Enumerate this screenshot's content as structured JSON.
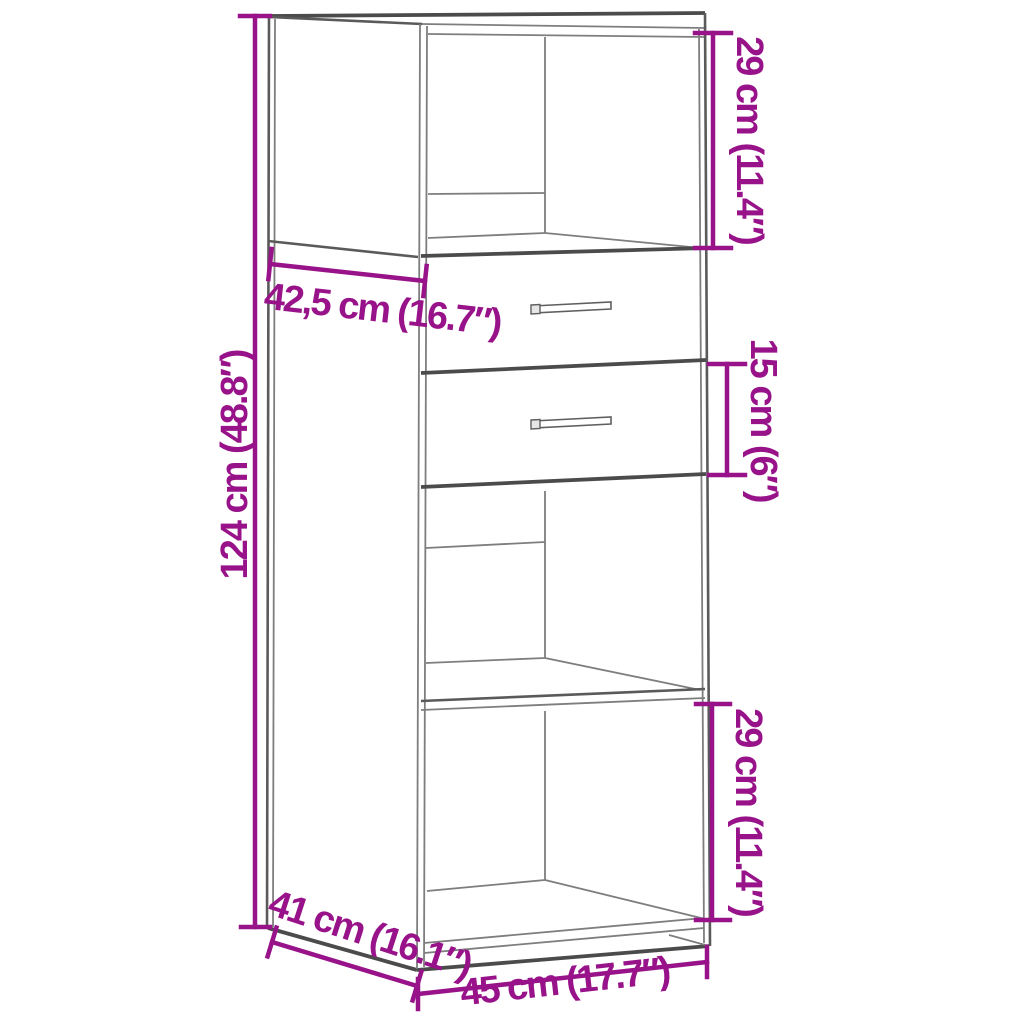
{
  "figure": {
    "title": "Highboard dimension diagram",
    "subject": "tall cabinet with open top niche, two drawers, one shelf compartment and bottom compartment",
    "background_color": "#ffffff",
    "accent_color": "#981389",
    "line_color_dark": "#4b4b4b",
    "line_color_light": "#7e7e7e",
    "dimensions": {
      "niche_height": "29 cm (11.4″)",
      "top_depth": "42,5 cm (16.7″)",
      "drawer_height": "15 cm (6″)",
      "total_height": "124 cm (48.8″)",
      "bottom_compartment_height": "29 cm (11.4″)",
      "depth": "41 cm (16.1″)",
      "width": "45 cm (17.7″)"
    }
  }
}
